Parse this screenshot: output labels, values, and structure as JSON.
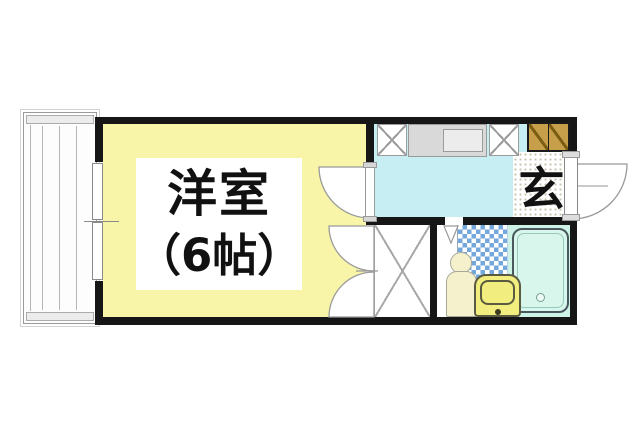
{
  "plan_type": "japanese-apartment-floor-plan",
  "texts": {
    "main_room_name": "洋室",
    "main_room_size": "（6帖）",
    "entrance_label": "玄"
  },
  "rooms": [
    {
      "name": "western-style-room",
      "label": "洋室（6帖）",
      "fill": "#f8f5a9"
    },
    {
      "name": "kitchen-hallway",
      "fill": "#c7eef2"
    },
    {
      "name": "entrance-genkan",
      "label": "玄",
      "fill": "#ffffff"
    },
    {
      "name": "closet",
      "fill": "#ffffff"
    },
    {
      "name": "bathroom-unit-bath",
      "tile_fill": "#74a7db",
      "fill": "#cdf2e6"
    },
    {
      "name": "balcony",
      "fill": "#fdfdfd"
    }
  ],
  "fixtures": [
    "kitchen-counter-with-sink",
    "appliance-space-left",
    "appliance-space-right",
    "shoe-cabinet",
    "bathtub",
    "toilet",
    "washbasin",
    "entrance-door-outswing",
    "room-hinged-door",
    "closet-double-doors",
    "bathroom-door-marker",
    "sliding-window-to-balcony"
  ],
  "colors": {
    "wall": "#161616",
    "room_yellow": "#f8f5a9",
    "hall_cyan": "#c7eef2",
    "bath_mint": "#cdf2e6",
    "tub_fill": "#d8f6ec",
    "tile_blue": "#74a7db",
    "cabinet_brown": "#c79f4a",
    "fixture_yellow": "#f1ed7e",
    "toilet_cream": "#f6f1cd",
    "line_gray": "#9a9a9a"
  }
}
